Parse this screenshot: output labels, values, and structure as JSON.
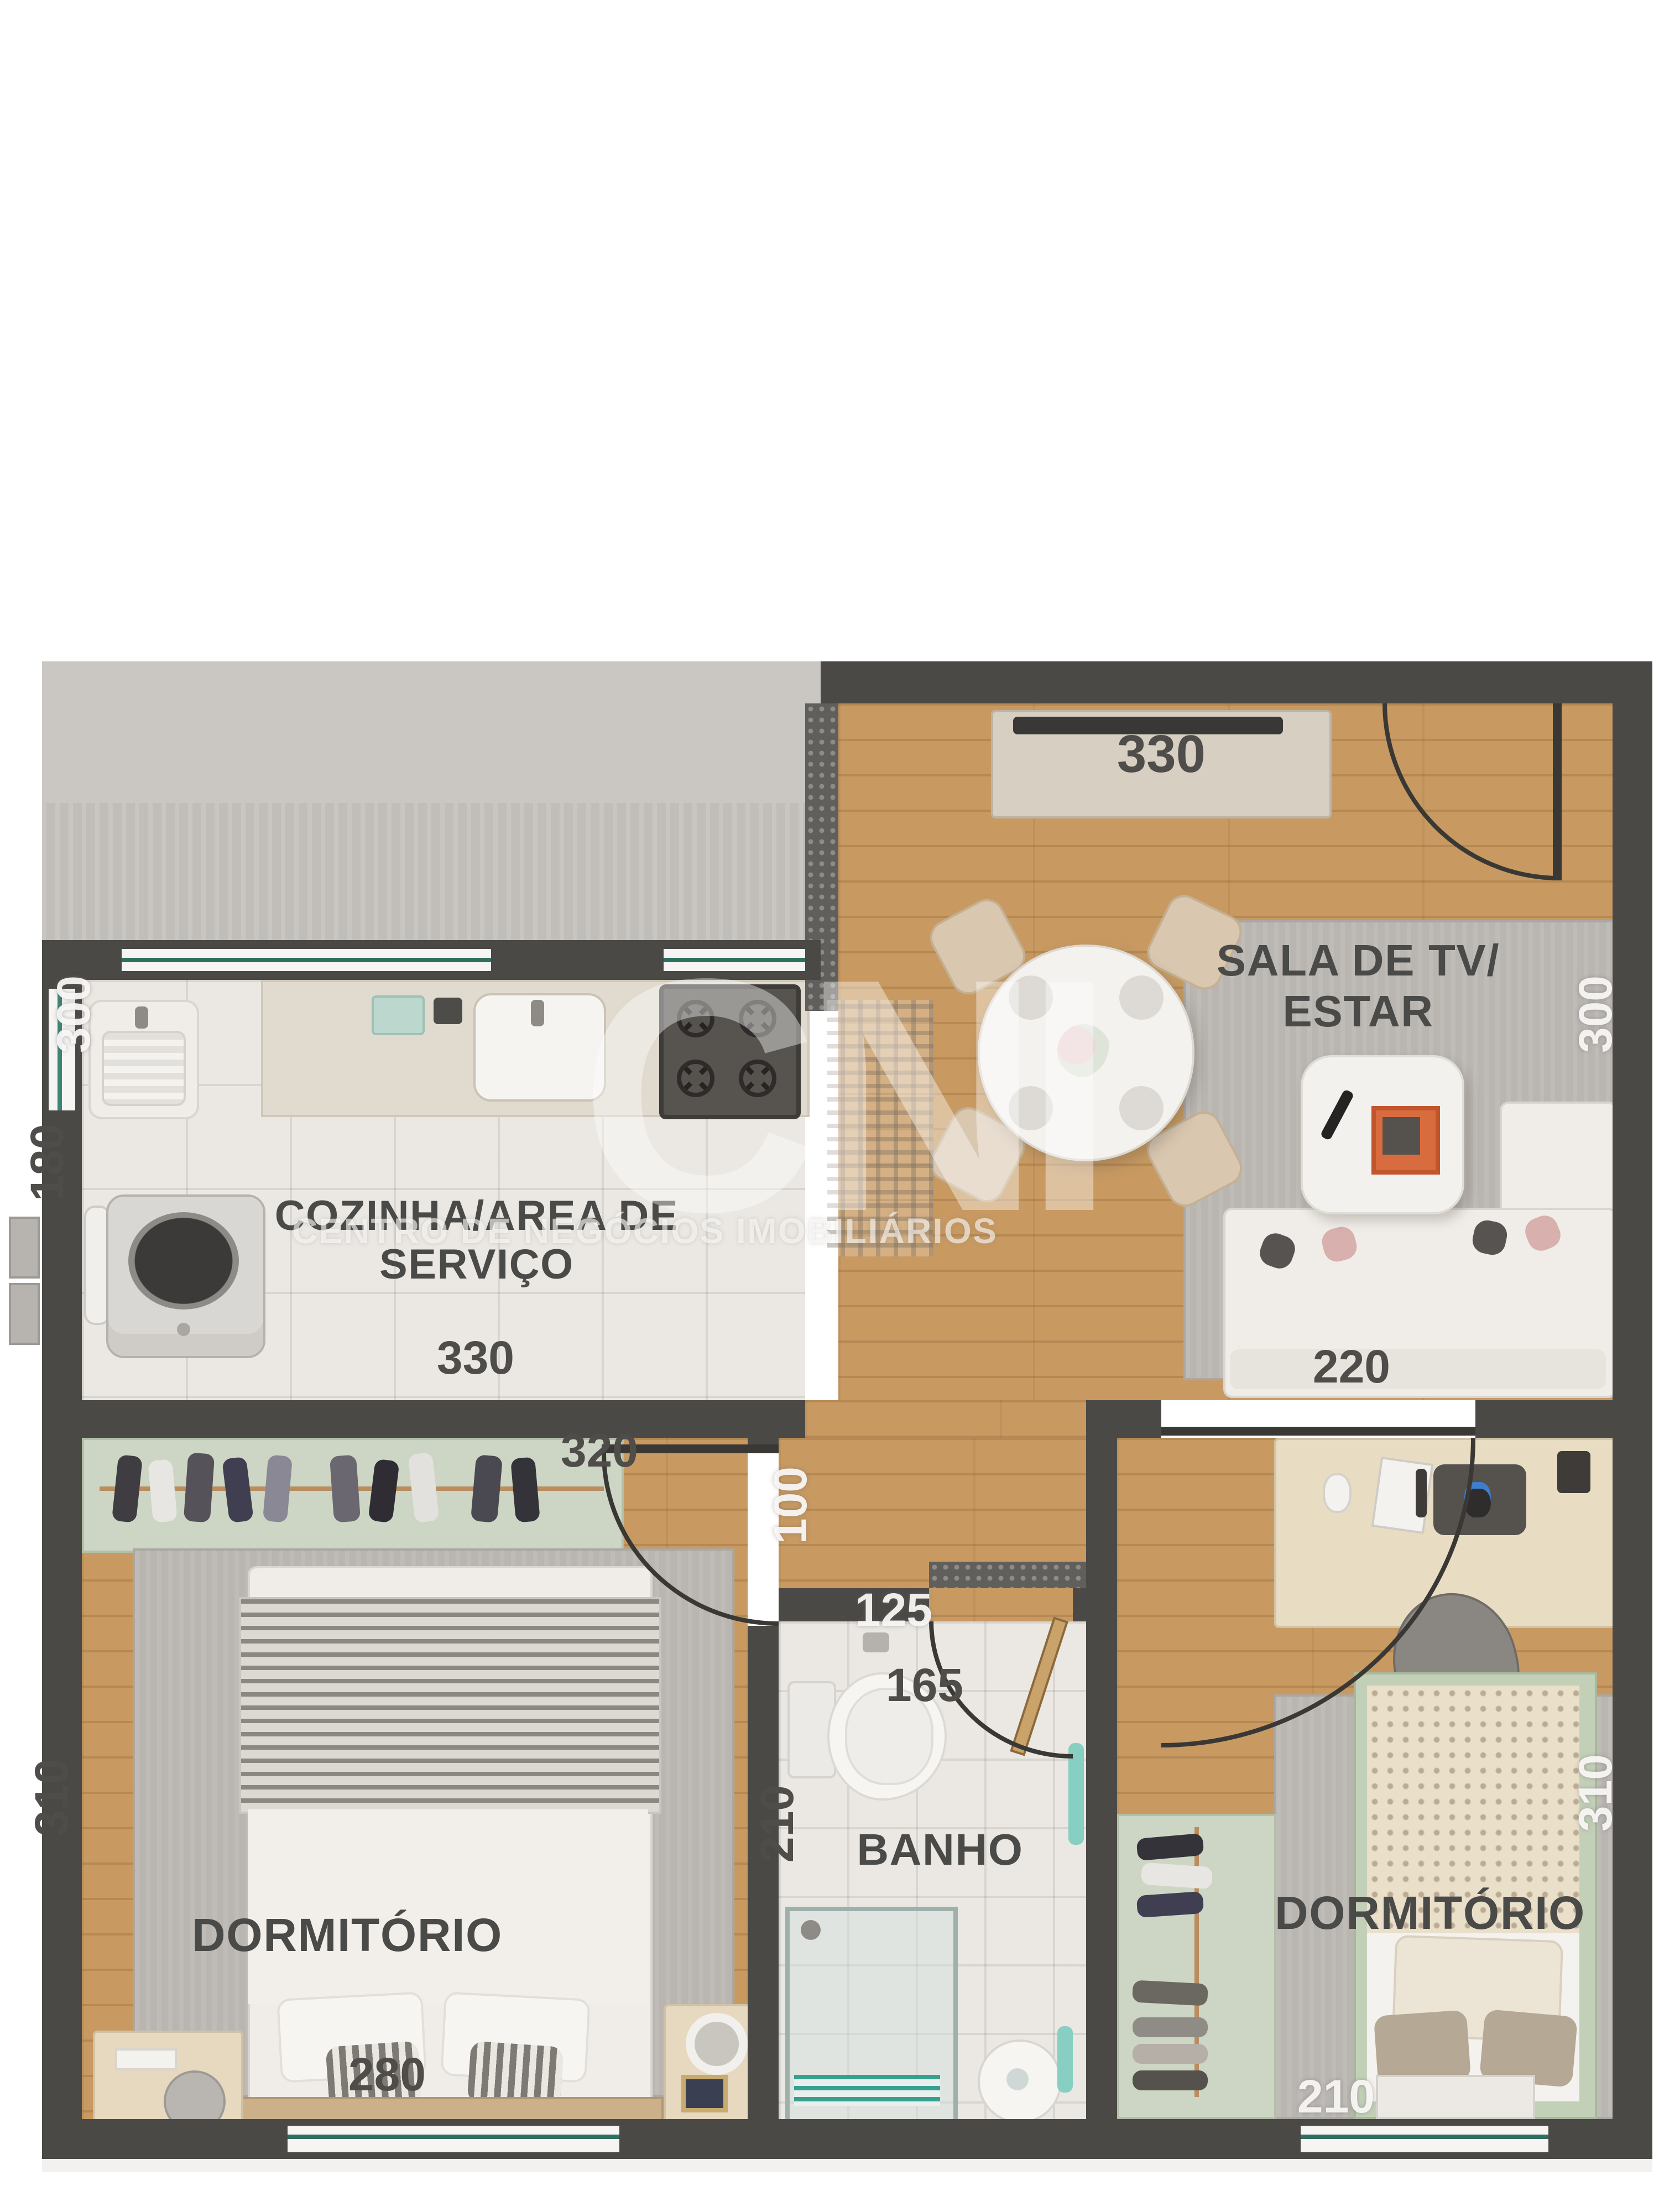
{
  "watermark": {
    "brand": "CNI",
    "tagline": "CENTRO  DE NEGÓCIOS IMOBILIÁRIOS"
  },
  "rooms": {
    "kitchen": {
      "line1": "COZINHA/AREA DE",
      "line2": "SERVIÇO"
    },
    "living": {
      "line1": "SALA DE TV/",
      "line2": "ESTAR"
    },
    "bedroom_left": {
      "label": "DORMITÓRIO"
    },
    "bedroom_right": {
      "label": "DORMITÓRIO"
    },
    "bathroom": {
      "label": "BANHO"
    }
  },
  "dimensions": {
    "living_top": "330",
    "living_right": "300",
    "sofa": "220",
    "laundry_corner": "300",
    "laundry_left": "180",
    "kitchen_bottom": "330",
    "bedroom_left_top": "320",
    "hall": "100",
    "hall_threshold": "125",
    "bath_top": "165",
    "bath_left": "210",
    "bedroom_left_side": "310",
    "bedroom_left_bottom": "280",
    "bedroom_right_side": "310",
    "bedroom_right_bottom": "210"
  },
  "colors": {
    "wall": "#4b4946",
    "wood_floor": "#c89a62",
    "tile_floor": "#ebe8e3",
    "rug": "#b9b5b1",
    "closet_green": "#cdd6c4",
    "accent_teal": "#6fc7b8",
    "label_dark": "#4a4a48",
    "label_light": "#f3f2f0",
    "exterior_gray": "#c8c5c1",
    "granite": "#615f5c"
  }
}
